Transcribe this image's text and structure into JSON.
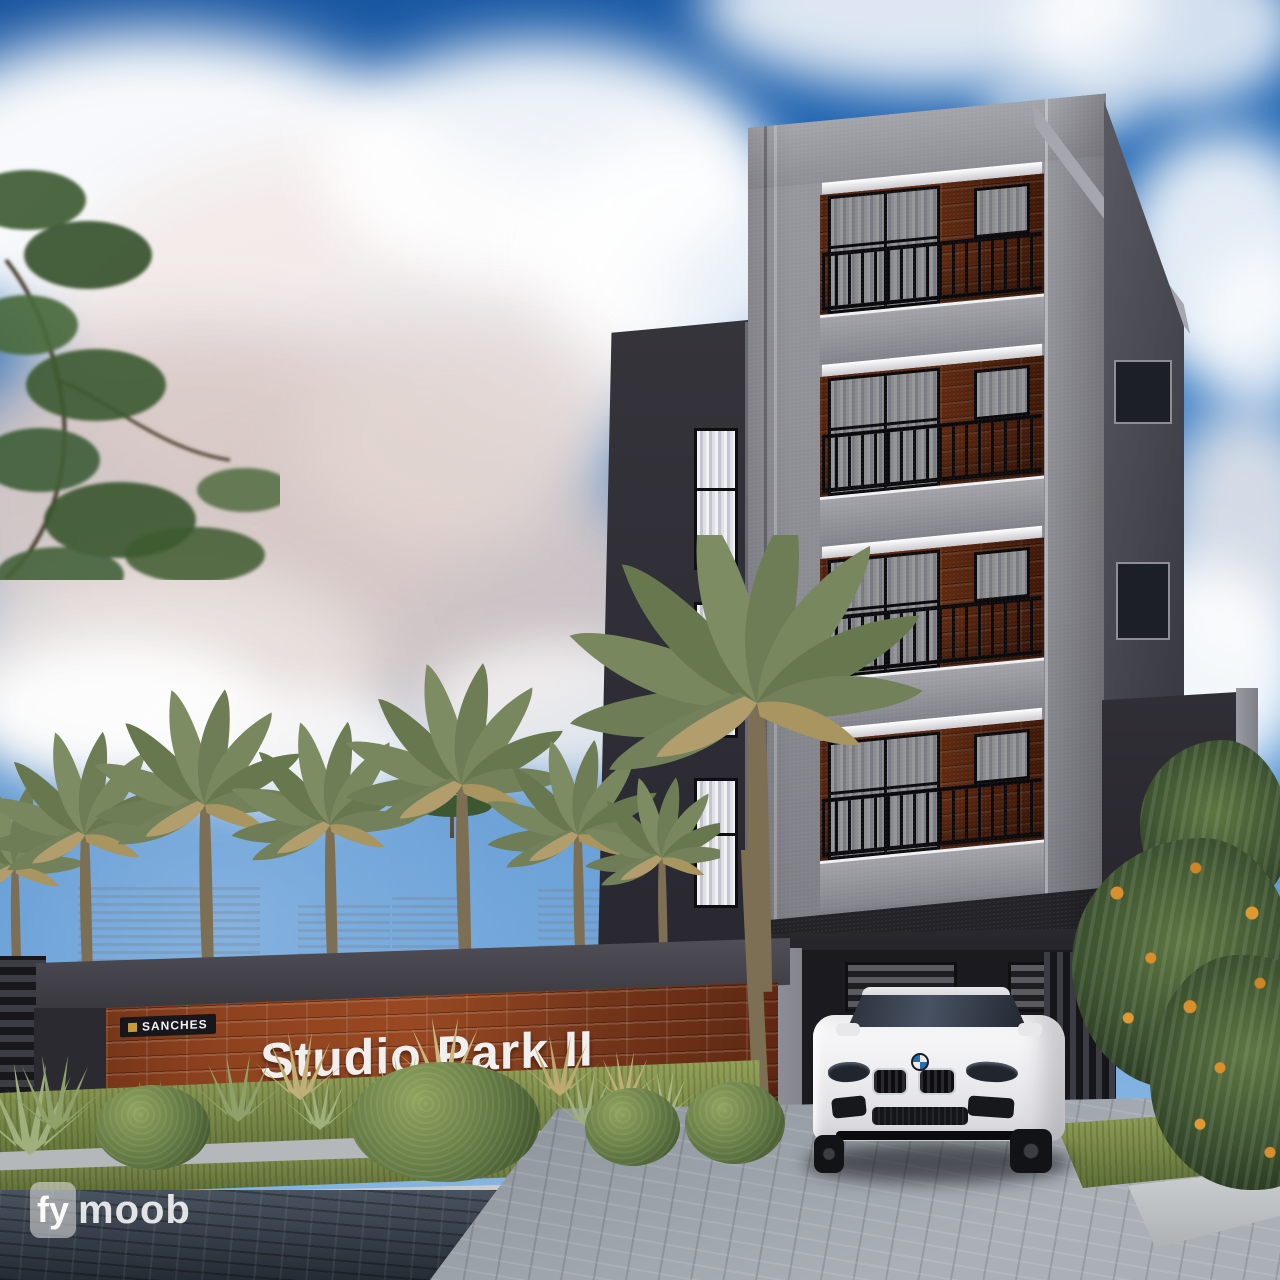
{
  "scene": {
    "type": "architectural-render",
    "sign": {
      "title": "Studio Park II",
      "brand": "SANCHES"
    },
    "watermark": {
      "part1": "fy",
      "part2": "moob"
    },
    "building": {
      "visible_balcony_floors": 4
    },
    "icons": {
      "car_badge": "bmw-roundel",
      "brand_logo": "gold-square"
    },
    "colors": {
      "sky": "#2b74c2",
      "cloud": "#ffffff",
      "cloud_shadow": "#d9cac7",
      "facade_gray": "#8b8b92",
      "facade_dark": "#2e2c33",
      "brick": "#7a3a1e",
      "sign_text": "#f2f0ee",
      "railing": "#15151a",
      "palm_green": "#76845d",
      "grass": "#7d8c4c",
      "street": "#39414e",
      "driveway": "#9aa1a8",
      "car": "#f4f4f6",
      "flower_accent": "#d98f2b"
    }
  }
}
